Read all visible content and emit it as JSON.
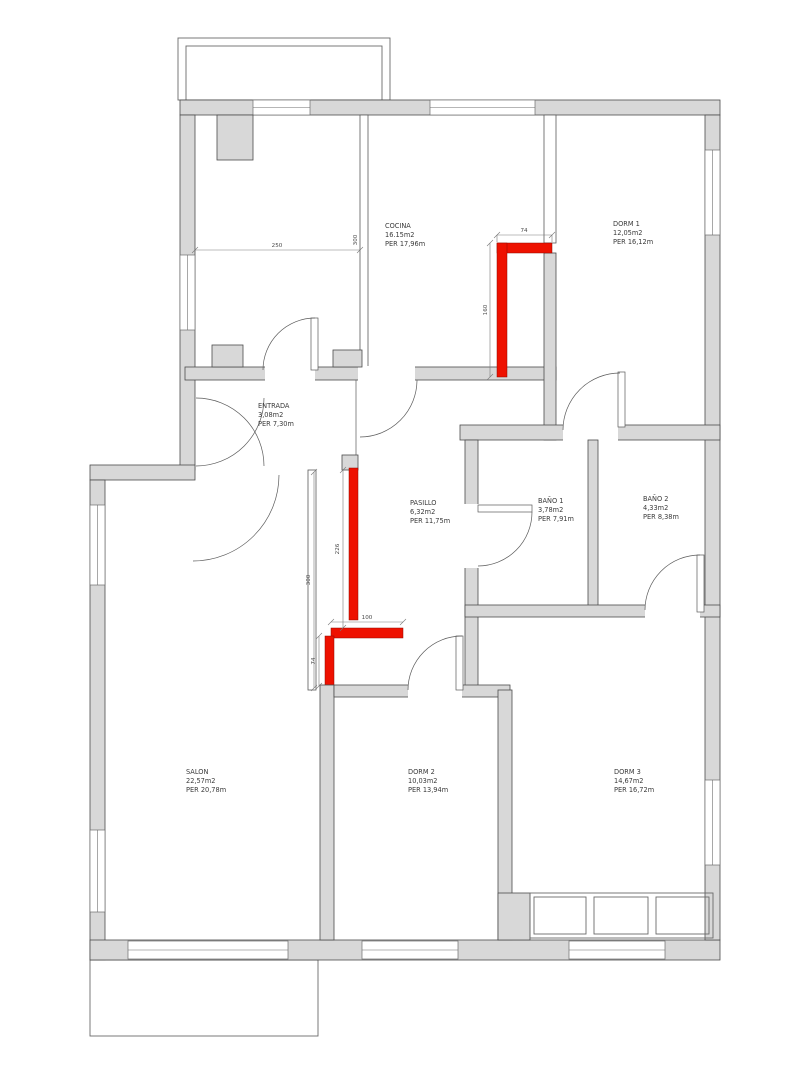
{
  "drawing": {
    "type": "apartment-floor-plan",
    "colors": {
      "wall_fill": "#d8d8d8",
      "wall_outline": "#4b4b4b",
      "highlight_wall": "#ee1100",
      "background": "#ffffff"
    }
  },
  "rooms": [
    {
      "id": "cocina",
      "name": "COCINA",
      "area": "16.15m2",
      "perimeter": "PER 17,96m"
    },
    {
      "id": "dorm1",
      "name": "DORM 1",
      "area": "12,05m2",
      "perimeter": "PER 16,12m"
    },
    {
      "id": "entrada",
      "name": "ENTRADA",
      "area": "3,08m2",
      "perimeter": "PER 7,30m"
    },
    {
      "id": "pasillo",
      "name": "PASILLO",
      "area": "6,32m2",
      "perimeter": "PER 11,75m"
    },
    {
      "id": "bano1",
      "name": "BAÑO 1",
      "area": "3,78m2",
      "perimeter": "PER 7,91m"
    },
    {
      "id": "bano2",
      "name": "BAÑO 2",
      "area": "4,33m2",
      "perimeter": "PER 8,38m"
    },
    {
      "id": "salon",
      "name": "SALON",
      "area": "22,57m2",
      "perimeter": "PER 20,78m"
    },
    {
      "id": "dorm2",
      "name": "DORM 2",
      "area": "10,03m2",
      "perimeter": "PER 13,94m"
    },
    {
      "id": "dorm3",
      "name": "DORM 3",
      "area": "14,67m2",
      "perimeter": "PER 16,72m"
    }
  ],
  "dims": {
    "left_room_width": "250",
    "left_room_height": "300",
    "red1_top": "74",
    "red1_side": "160",
    "red2_side": "226",
    "salon_side": "300",
    "red2_bottom": "100",
    "red2_stub": "74"
  }
}
